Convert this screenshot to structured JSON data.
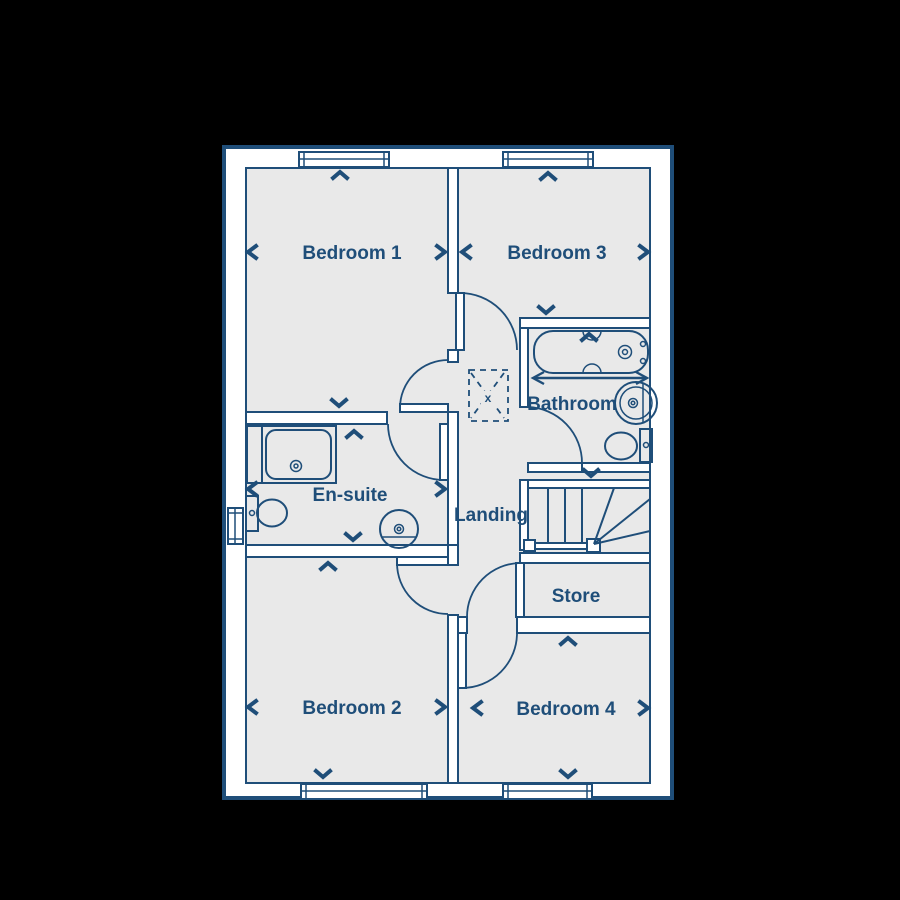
{
  "plan": {
    "type": "first-floor-plan",
    "rooms": {
      "bedroom1": {
        "label": "Bedroom 1"
      },
      "bedroom2": {
        "label": "Bedroom 2"
      },
      "bedroom3": {
        "label": "Bedroom 3"
      },
      "bedroom4": {
        "label": "Bedroom 4"
      },
      "bathroom": {
        "label": "Bathroom"
      },
      "ensuite": {
        "label": "En-suite"
      },
      "landing": {
        "label": "Landing"
      },
      "store": {
        "label": "Store"
      }
    },
    "symbols": {
      "loft_hatch_mark": "x"
    },
    "colors": {
      "line_navy": "#1F4E79",
      "floor_gray": "#E9E9E9",
      "wall_white": "#FFFFFF",
      "background": "#000000"
    },
    "elements": {
      "windows": [
        "bedroom-1-window",
        "bedroom-3-window",
        "bedroom-2-window",
        "bedroom-4-window",
        "en-suite-window"
      ],
      "doors": [
        "bedroom-1-door",
        "bedroom-2-door",
        "bedroom-3-door",
        "bedroom-4-door",
        "en-suite-door",
        "bathroom-door",
        "store-door"
      ],
      "fixtures": [
        "bath-tub",
        "shower-enclosure",
        "en-suite-toilet",
        "en-suite-basin",
        "bathroom-toilet",
        "bathroom-basin",
        "staircase",
        "loft-hatch"
      ]
    }
  }
}
